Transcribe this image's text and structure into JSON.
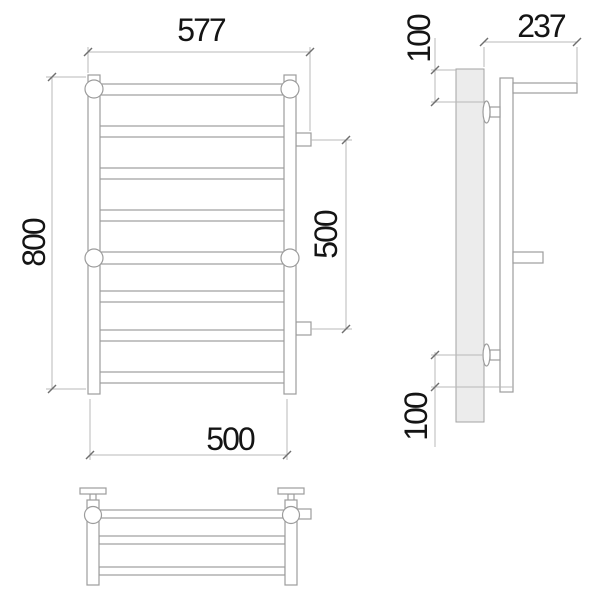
{
  "dimensions": {
    "front": {
      "overall_width": "577",
      "overall_height": "800",
      "rail_width": "500",
      "connection_spacing": "500"
    },
    "side": {
      "overall_depth": "237",
      "top_mount_offset": "100",
      "bottom_mount_offset": "100"
    }
  },
  "colors": {
    "outline": "#9c9c9c",
    "wall_fill": "#ececec",
    "dimension_line": "#b9b9b9",
    "tick": "#6f6f6f",
    "label": "#141414",
    "background": "#ffffff"
  }
}
